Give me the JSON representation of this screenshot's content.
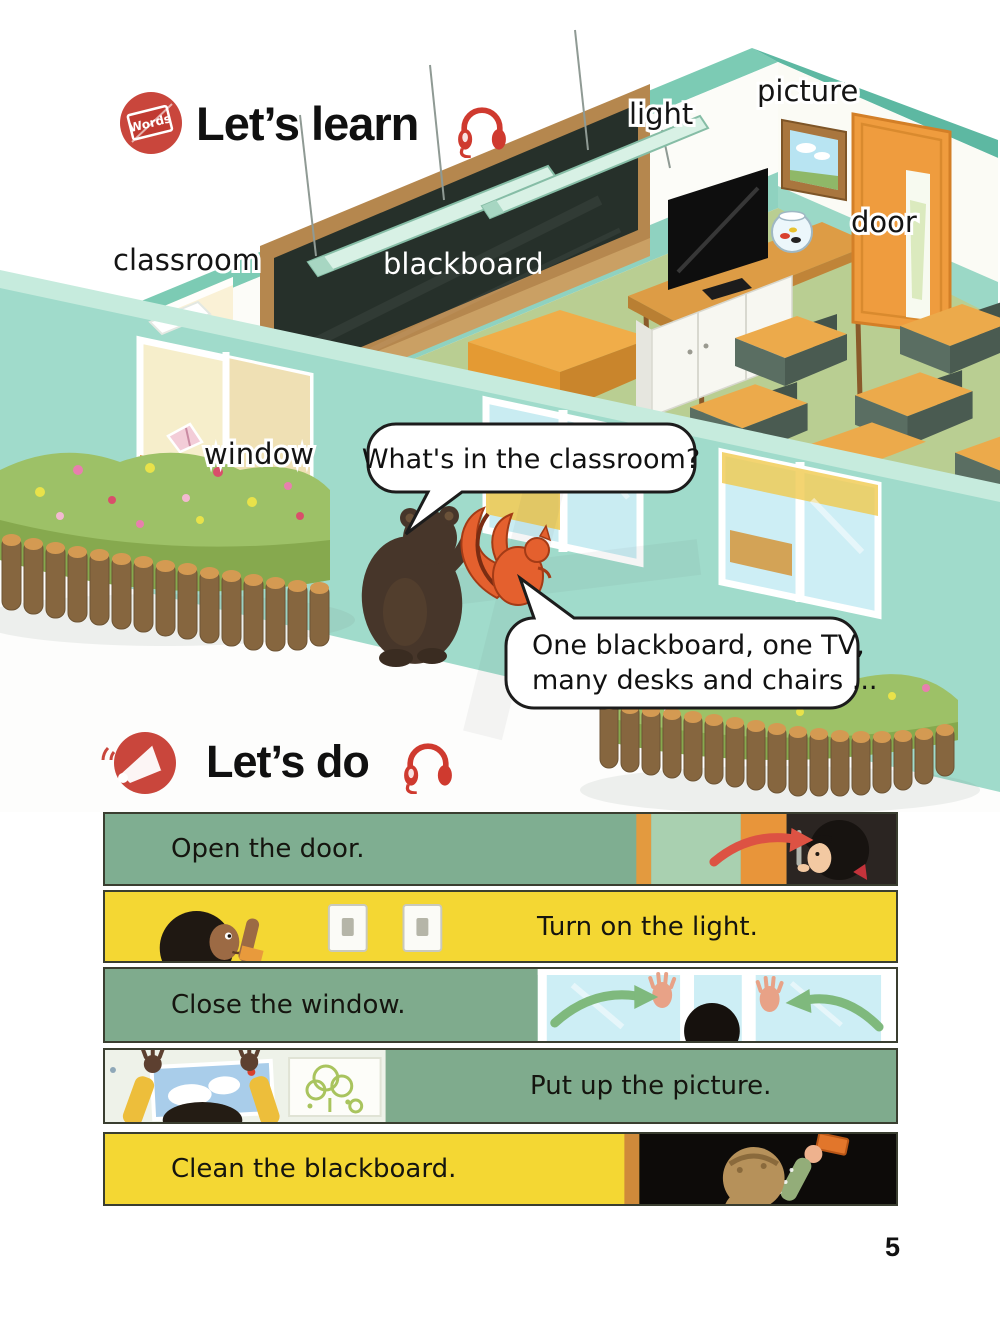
{
  "page": {
    "number": "5"
  },
  "palette": {
    "accent_red": "#c8423a",
    "wall_teal": "#a0dbcb",
    "floor_green": "#b9ce92",
    "door_orange": "#ef9c3e",
    "strip_green": "#7fab8d",
    "strip_yellow": "#f4d733",
    "blackboard_dark": "#26302a"
  },
  "lets_learn": {
    "badge_label": "Words",
    "title": "Let’s learn",
    "labels": {
      "classroom": "classroom",
      "blackboard": "blackboard",
      "light": "light",
      "picture": "picture",
      "door": "door",
      "window": "window"
    },
    "speech_bubbles": {
      "bear_question": "What's in the classroom?",
      "squirrel_answer_line1": "One blackboard, one TV,",
      "squirrel_answer_line2": "many desks and chairs ..."
    }
  },
  "lets_do": {
    "title": "Let’s do",
    "actions": [
      {
        "id": "open-door",
        "label": "Open the door."
      },
      {
        "id": "turn-on-light",
        "label": "Turn on the light."
      },
      {
        "id": "close-window",
        "label": "Close the window."
      },
      {
        "id": "put-up-picture",
        "label": "Put up the picture."
      },
      {
        "id": "clean-blackboard",
        "label": "Clean the blackboard."
      }
    ]
  }
}
